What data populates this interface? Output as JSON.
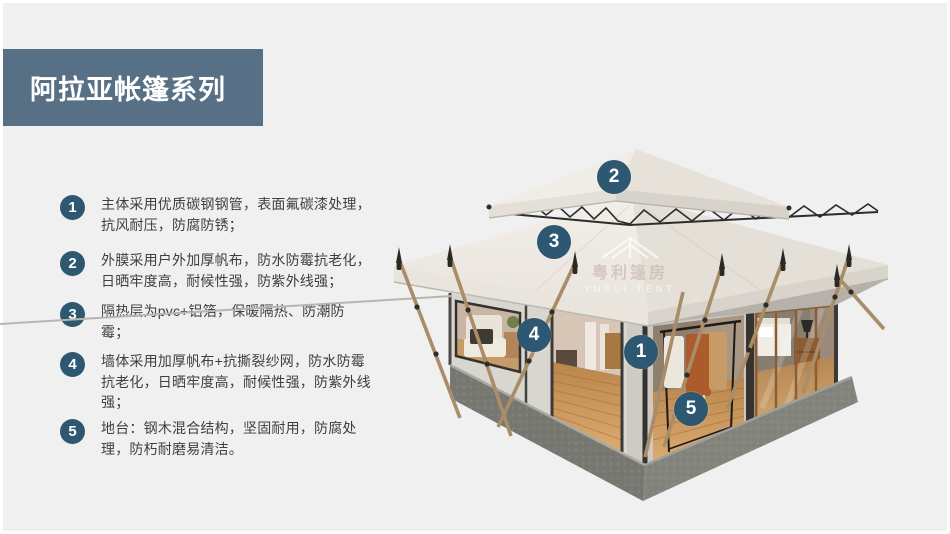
{
  "title": {
    "text": "阿拉亚帐篷系列"
  },
  "features": [
    {
      "num": "1",
      "text": "主体采用优质碳钢钢管，表面氟碳漆处理，抗风耐压，防腐防锈；"
    },
    {
      "num": "2",
      "text": "外膜采用户外加厚帆布，防水防霉抗老化，日晒牢度高，耐候性强，防紫外线强；"
    },
    {
      "num": "3",
      "text": "隔热层为pvc+铝箔，保暖隔热、防潮防霉；"
    },
    {
      "num": "4",
      "text": "墙体采用加厚帆布+抗撕裂纱网，防水防霉抗老化，日晒牢度高，耐候性强，防紫外线强；"
    },
    {
      "num": "5",
      "text": "地台：钢木混合结构，坚固耐用，防腐处理，防朽耐磨易清洁。"
    }
  ],
  "image_markers": [
    {
      "num": "1",
      "x": 641,
      "y": 352
    },
    {
      "num": "2",
      "x": 614,
      "y": 177
    },
    {
      "num": "3",
      "x": 554,
      "y": 242
    },
    {
      "num": "4",
      "x": 534,
      "y": 335
    },
    {
      "num": "5",
      "x": 691,
      "y": 409
    }
  ],
  "watermark": {
    "cn": "粤利篷房",
    "en": "YUELI TENT"
  },
  "colors": {
    "accent_circle": "#2e5871",
    "banner": "#577086",
    "body_text": "#3d4043",
    "background": "#f0f0f1"
  }
}
